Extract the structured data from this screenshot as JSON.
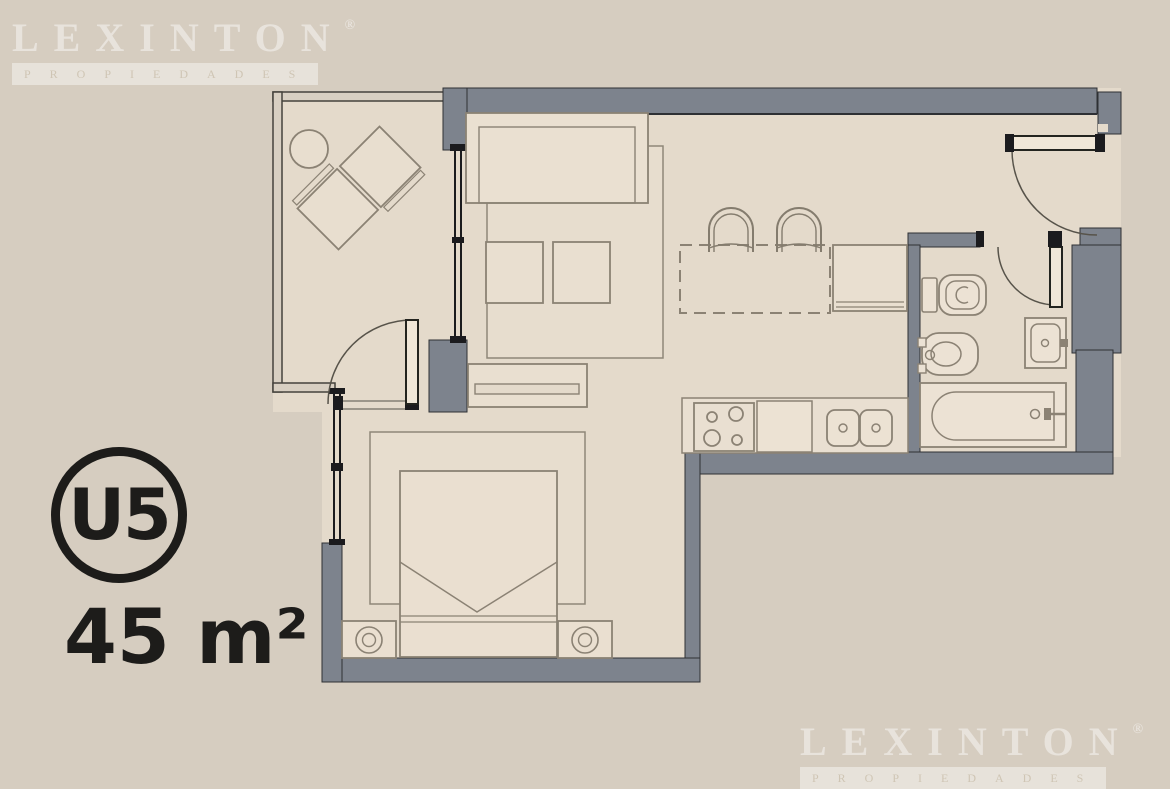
{
  "unit": {
    "label": "U5",
    "area": "45 m²"
  },
  "watermark": {
    "brand": "LEXINTON",
    "registered": "®",
    "subtitle": "PROPIEDADES"
  },
  "plan": {
    "rooms": [
      "balcony",
      "living-dining",
      "kitchen",
      "entry",
      "bathroom",
      "bedroom"
    ],
    "fixtures": [
      "round-table",
      "balcony-chairs",
      "sofa",
      "living-rug",
      "coffee-tables",
      "tv-console",
      "dining-island",
      "bar-stools",
      "refrigerator",
      "cooktop",
      "kitchen-sink",
      "bed",
      "bedroom-rug",
      "nightstand-left",
      "nightstand-right",
      "table-lamps",
      "toilet",
      "bidet",
      "vanity-sink",
      "bathtub",
      "door-balcony",
      "door-entrance",
      "door-bathroom",
      "window-living",
      "window-bedroom",
      "balcony-railing"
    ]
  },
  "colors": {
    "background": "#d6cdc0",
    "floor": "#e4dacb",
    "wall": "#7d838d",
    "wall_edge": "#2e3034",
    "furniture_line": "#8b8274",
    "window_line": "#1b1b1e",
    "badge_text": "#1d1c1a",
    "watermark": "rgba(255,255,255,0.45)"
  }
}
